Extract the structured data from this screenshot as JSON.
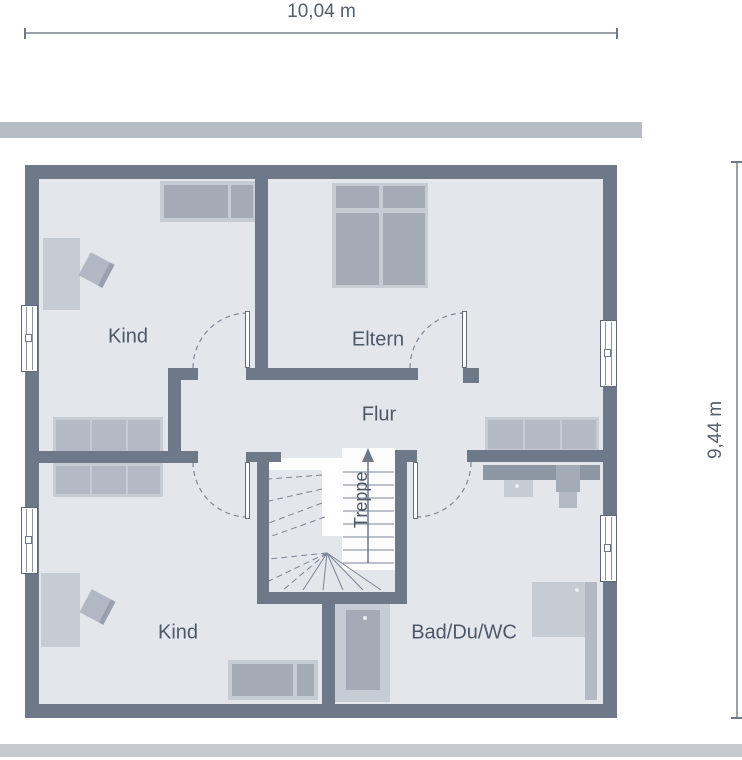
{
  "dimensions": {
    "width": "10,04 m",
    "height": "9,44 m"
  },
  "rooms": {
    "kind_top": "Kind",
    "eltern": "Eltern",
    "flur": "Flur",
    "treppe": "Treppe",
    "kind_bottom": "Kind",
    "bad": "Bad/Du/WC"
  },
  "colors": {
    "wall": "#6d7888",
    "floor": "#e3e7ec",
    "furniture_light": "#c6ccd4",
    "furniture_medium": "#a3abb7",
    "furniture_dark": "#8d97a3",
    "band_top": "#b8bdc5",
    "band_bottom": "#c7cacf",
    "label_text": "#4d5866",
    "dimension_text": "#555f6b"
  }
}
